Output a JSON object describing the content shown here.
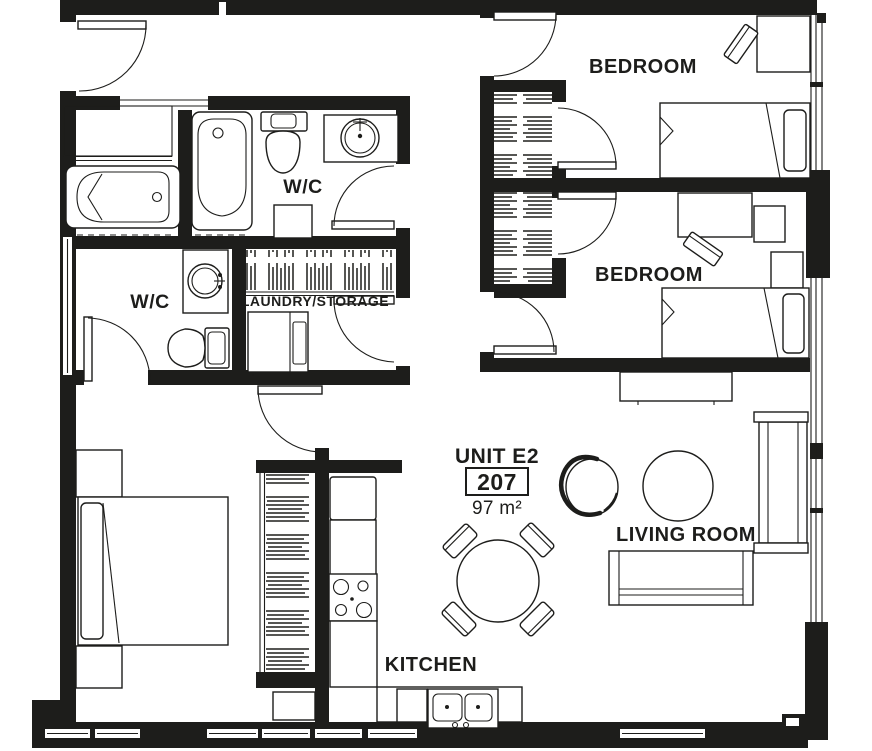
{
  "unit": {
    "name": "UNIT E2",
    "number": "207",
    "area": "97 m²"
  },
  "rooms": {
    "bedroom_top": {
      "label": "BEDROOM"
    },
    "bedroom_middle": {
      "label": "BEDROOM"
    },
    "living_room": {
      "label": "LIVING ROOM"
    },
    "kitchen": {
      "label": "KITCHEN"
    },
    "wc_top": {
      "label": "W/C"
    },
    "wc_lower": {
      "label": "W/C"
    },
    "laundry": {
      "label": "LAUNDRY/STORAGE"
    }
  },
  "colors": {
    "wall": "#1d1d1b",
    "line": "#1d1d1b",
    "background": "#ffffff"
  }
}
